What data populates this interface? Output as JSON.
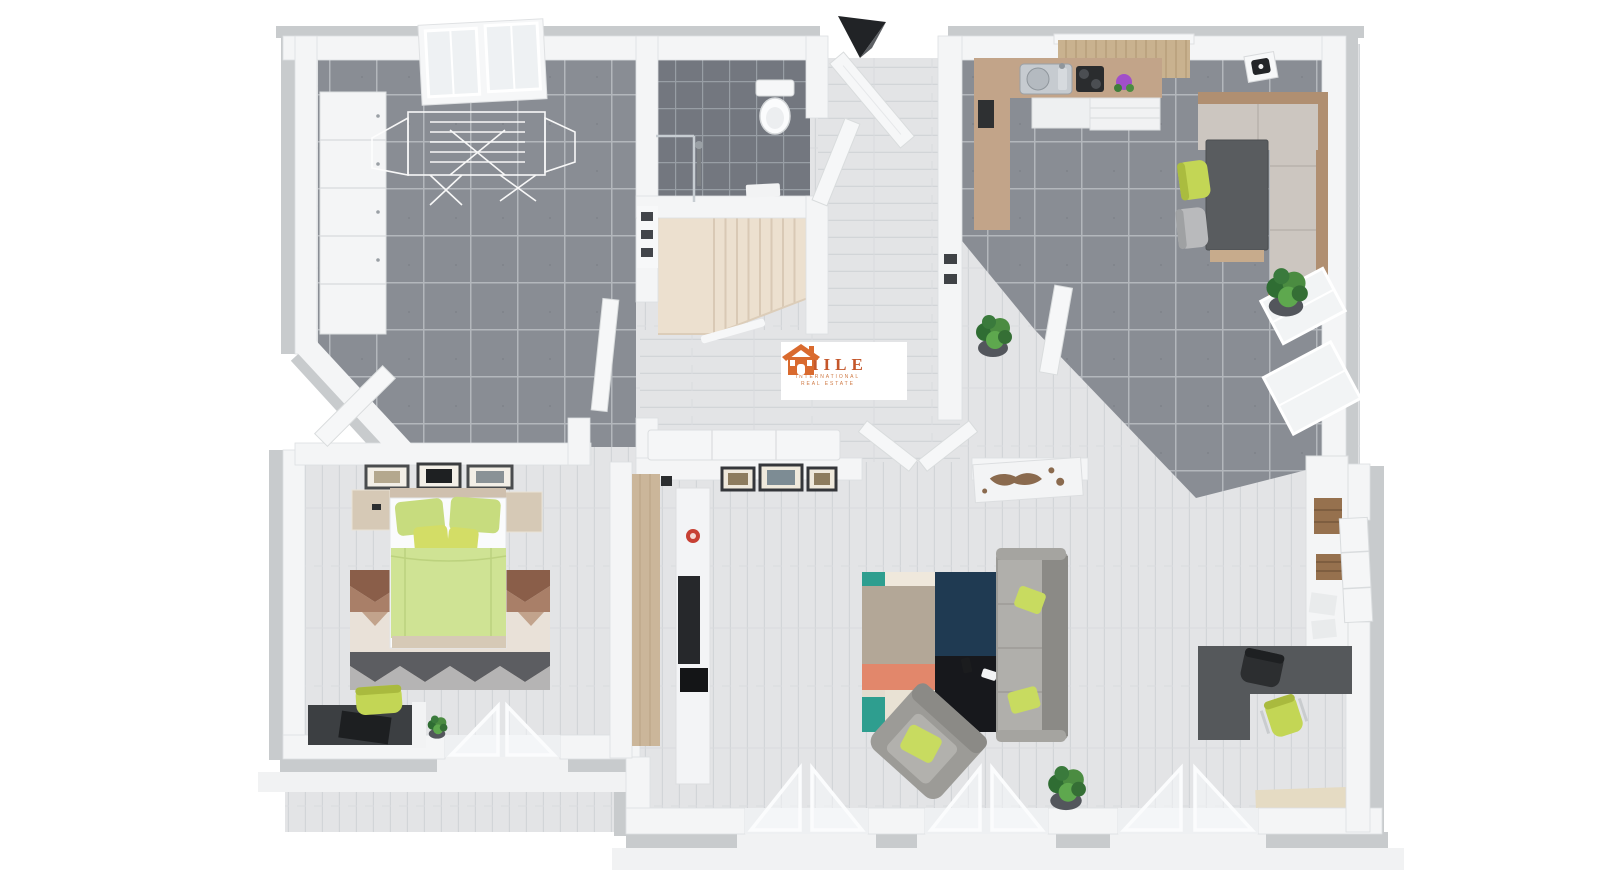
{
  "brand_card": {
    "name": "SMILE",
    "subtitle_line1": "INTERNATIONAL",
    "subtitle_line2": "REAL ESTATE"
  },
  "icons": {
    "house-logo-icon": "orange house with chimney",
    "entrance-arrow": "black 3d chevron marking entrance door",
    "drying-rack-icon": "white wire laundry rack",
    "toilet-icon": "toilet with tank",
    "shower-icon": "glass shower corner",
    "staircase-icon": "quarter-turn cream stairs",
    "skylight-icon": "double sloped roof window",
    "kitchen-sink-icon": "steel sink with faucet",
    "cooktop-icon": "black 2-burner hob",
    "smoke-detector-icon": "ceiling detector",
    "potted-plant-icon": "green plant in pot",
    "open-door-icon": "white open door leaf",
    "open-window-icon": "triangular open casement panes"
  },
  "colors": {
    "brand_orange": "#C4562A",
    "wall_white": "#F4F5F6",
    "wall_shadow_gray": "#C8CBCD",
    "tile_dark_gray": "#898D94",
    "tile_bath_gray": "#73777F",
    "wood_whitewash": "#E3E4E6",
    "stairs_cream": "#ECE0CF",
    "accent_lime": "#C3D655",
    "duvet_green": "#CFE394",
    "counter_wood": "#C2A489",
    "sofa_gray": "#9C9B97",
    "rug_teal": "#2E9E8F",
    "rug_navy": "#1F3A52",
    "rug_black": "#17181C",
    "rug_salmon": "#E2876B",
    "rug_brown": "#8A5E49",
    "desk_charcoal": "#4A4D50"
  }
}
